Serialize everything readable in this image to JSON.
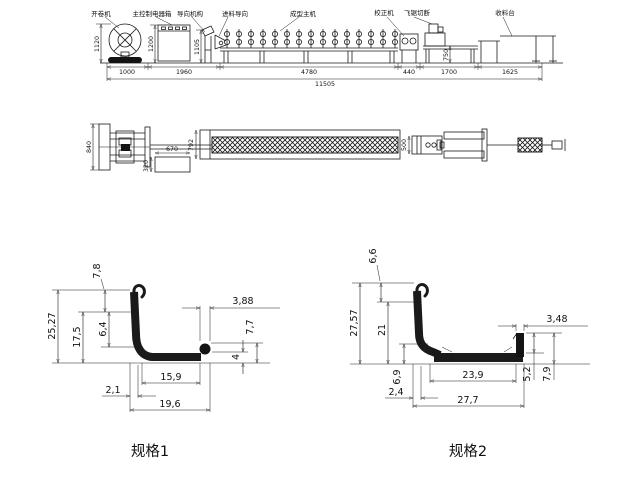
{
  "elevation": {
    "labels": {
      "uncoiler": "开卷机",
      "control_box": "主控制电器箱",
      "guide": "导向机构",
      "feed_guide": "进料导向",
      "forming_machine": "成型主机",
      "straightener": "校正机",
      "flying_saw": "飞锯切断",
      "collect_table": "收料台"
    },
    "dims": {
      "seg_1000": "1000",
      "seg_1960": "1960",
      "seg_4780": "4780",
      "seg_440": "440",
      "seg_1700": "1700",
      "seg_1625": "1625",
      "total": "11505",
      "h_uncoiler": "1120",
      "h_control": "1200",
      "h_guide": "1105",
      "h_saw_table": "750"
    }
  },
  "plan": {
    "dims": {
      "uncoiler_width": "840",
      "box_length": "670",
      "box_width": "320",
      "machine_width": "792",
      "straightener_len": "500"
    }
  },
  "profile1": {
    "title": "规格1",
    "dims": {
      "top": "7,8",
      "overall_h": "25,27",
      "wall_h": "17,5",
      "mid_h": "6,4",
      "bead_w": "3,88",
      "bead_h": "7,7",
      "base_h": "4",
      "inner_w": "15,9",
      "thk": "2,1",
      "overall_w": "19,6"
    }
  },
  "profile2": {
    "title": "规格2",
    "dims": {
      "top": "6,6",
      "overall_h": "27,57",
      "wall_h": "21",
      "low_h": "6,9",
      "thk": "2,4",
      "inner_w": "23,9",
      "overall_w": "27,7",
      "flange_in": "5,2",
      "flange_out": "7,9",
      "flange_w": "3,48"
    }
  }
}
